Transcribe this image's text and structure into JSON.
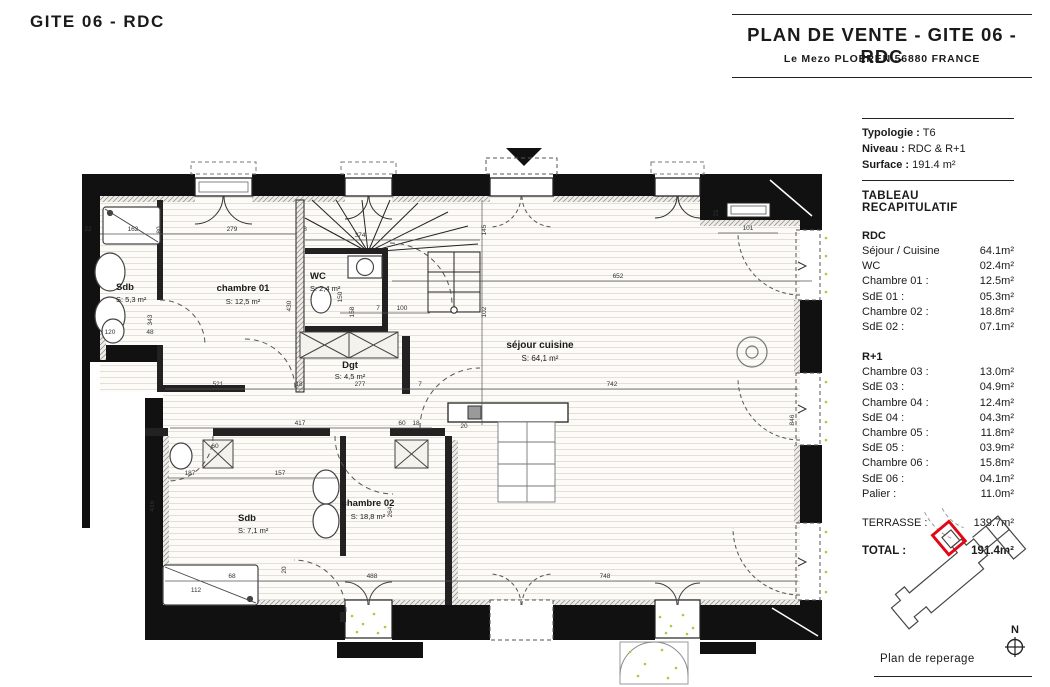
{
  "header": {
    "page_title": "GITE 06 - RDC"
  },
  "title_block": {
    "title": "PLAN DE VENTE - GITE 06 - RDC",
    "subtitle": "Le Mezo PLOEREN 56880 FRANCE"
  },
  "info": {
    "rows": [
      {
        "label": "Typologie :",
        "value": "T6"
      },
      {
        "label": "Niveau :",
        "value": "RDC & R+1"
      },
      {
        "label": "Surface :",
        "value": "191.4 m²"
      }
    ]
  },
  "recap": {
    "heading": "TABLEAU RECAPITULATIF",
    "rdc": {
      "title": "RDC",
      "rows": [
        [
          "Séjour / Cuisine",
          "64.1m²"
        ],
        [
          "WC",
          "02.4m²"
        ],
        [
          "Chambre 01 :",
          "12.5m²"
        ],
        [
          "SdE 01 :",
          "05.3m²"
        ],
        [
          "Chambre 02 :",
          "18.8m²"
        ],
        [
          "SdE 02 :",
          "07.1m²"
        ]
      ]
    },
    "r1": {
      "title": "R+1",
      "rows": [
        [
          "Chambre 03 :",
          "13.0m²"
        ],
        [
          "SdE 03 :",
          "04.9m²"
        ],
        [
          "Chambre 04 :",
          "12.4m²"
        ],
        [
          "SdE 04 :",
          "04.3m²"
        ],
        [
          "Chambre 05 :",
          "11.8m²"
        ],
        [
          "SdE 05 :",
          "03.9m²"
        ],
        [
          "Chambre 06 :",
          "15.8m²"
        ],
        [
          "SdE 06 :",
          "04.1m²"
        ],
        [
          "Palier :",
          "11.0m²"
        ]
      ]
    },
    "terrasse": [
      "TERRASSE :",
      "139.7m²"
    ],
    "total": [
      "TOTAL :",
      "191.4m²"
    ]
  },
  "site": {
    "caption": "Plan de reperage",
    "north": "N",
    "highlight_color": "#e30613"
  },
  "plan": {
    "rooms": [
      {
        "name": "Sdb",
        "area": "S: 5,3 m²"
      },
      {
        "name": "chambre 01",
        "area": "S: 12,5 m²"
      },
      {
        "name": "WC",
        "area": "S: 2,4 m²"
      },
      {
        "name": "Dgt",
        "area": "S: 4,5 m²"
      },
      {
        "name": "séjour cuisine",
        "area": "S: 64,1 m²"
      },
      {
        "name": "chambre 02",
        "area": "S: 18,8 m²"
      },
      {
        "name": "Sdb",
        "area": "S: 7,1 m²"
      }
    ],
    "dims": [
      "279",
      "374",
      "652",
      "101",
      "22",
      "162",
      "120",
      "48",
      "521",
      "18",
      "277",
      "7",
      "742",
      "417",
      "60",
      "18",
      "100",
      "7",
      "187",
      "157",
      "68",
      "488",
      "748",
      "112",
      "20",
      "8",
      "21",
      "80",
      "430",
      "145",
      "102",
      "343",
      "150",
      "158",
      "416",
      "264",
      "846",
      "20",
      "60"
    ]
  }
}
